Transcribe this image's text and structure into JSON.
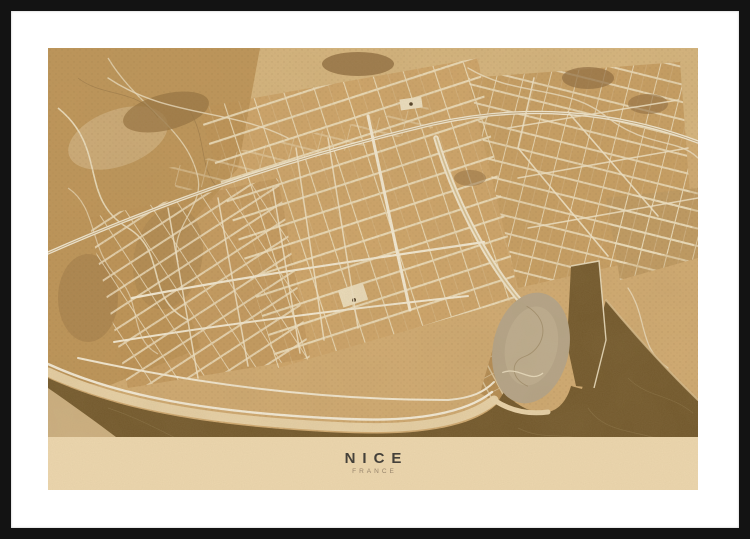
{
  "poster": {
    "title": "NICE",
    "subtitle": "FRANCE",
    "style": "sepia-vintage-map"
  },
  "colors": {
    "frame": "#131313",
    "mat": "#ffffff",
    "paper": "#d2ab72",
    "sea": "#6f5529",
    "caption_band": "#ecd6ae",
    "street": "#f5ecd7",
    "beach": "#ecd7ae",
    "castle_hill": "#b5a58a",
    "park": "#8d6a3d",
    "title_text": "#45413a",
    "subtitle_text": "#97846b"
  }
}
